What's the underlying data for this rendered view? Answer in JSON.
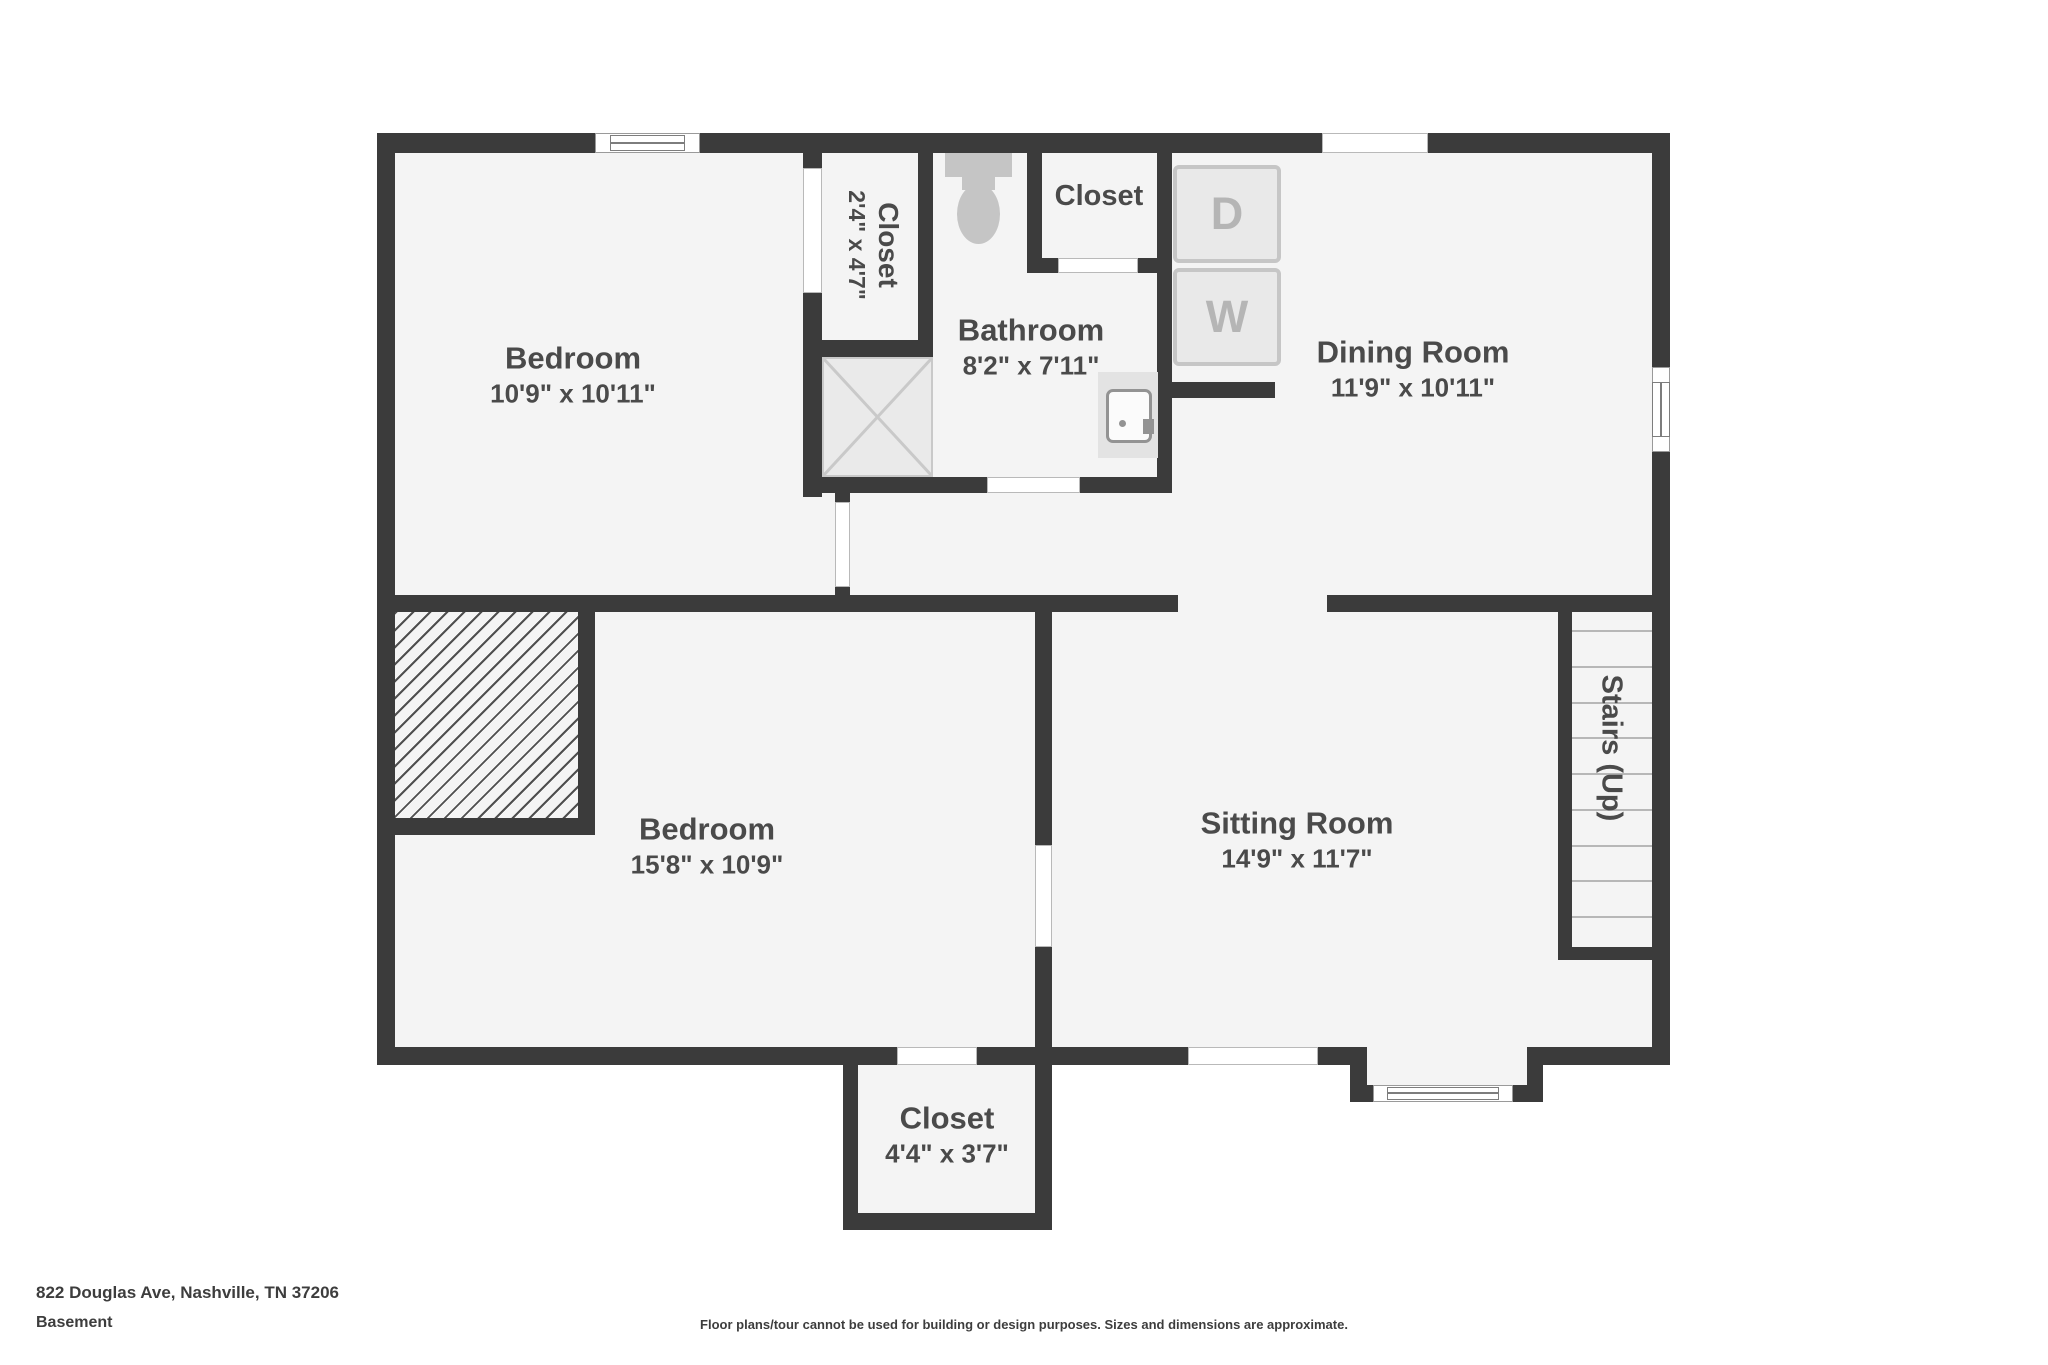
{
  "rooms": {
    "bedroom_upper": {
      "name": "Bedroom",
      "dims": "10'9\" x 10'11\""
    },
    "closet_upper_left": {
      "name": "Closet",
      "dims": "2'4\" x 4'7\""
    },
    "bathroom": {
      "name": "Bathroom",
      "dims": "8'2\" x 7'11\""
    },
    "closet_top": {
      "name": "Closet"
    },
    "dining_room": {
      "name": "Dining Room",
      "dims": "11'9\" x 10'11\""
    },
    "bedroom_lower": {
      "name": "Bedroom",
      "dims": "15'8\" x 10'9\""
    },
    "sitting_room": {
      "name": "Sitting Room",
      "dims": "14'9\" x 11'7\""
    },
    "closet_bottom": {
      "name": "Closet",
      "dims": "4'4\" x 3'7\""
    },
    "stairs": {
      "label": "Stairs (Up)",
      "treads": 9
    }
  },
  "appliances": {
    "dryer": "D",
    "washer": "W"
  },
  "footer": {
    "address": "822 Douglas Ave, Nashville, TN 37206",
    "level": "Basement",
    "disclaimer": "Floor plans/tour cannot be used for building or design purposes. Sizes and dimensions are approximate."
  },
  "colors": {
    "wall": "#3b3b3b",
    "floor": "#f4f4f4",
    "label": "#4a4a4a",
    "appliance_border": "#c6c6c6",
    "appliance_fill": "#e9e9e9",
    "appliance_letter": "#b5b5b5",
    "fixture": "#c5c5c5",
    "shower_line": "#c9c9c9",
    "tread": "#b7b7b7",
    "door_line": "#b9b9b9",
    "hatch_line": "#4f4f4f",
    "footer_text": "#3d3d3d"
  }
}
